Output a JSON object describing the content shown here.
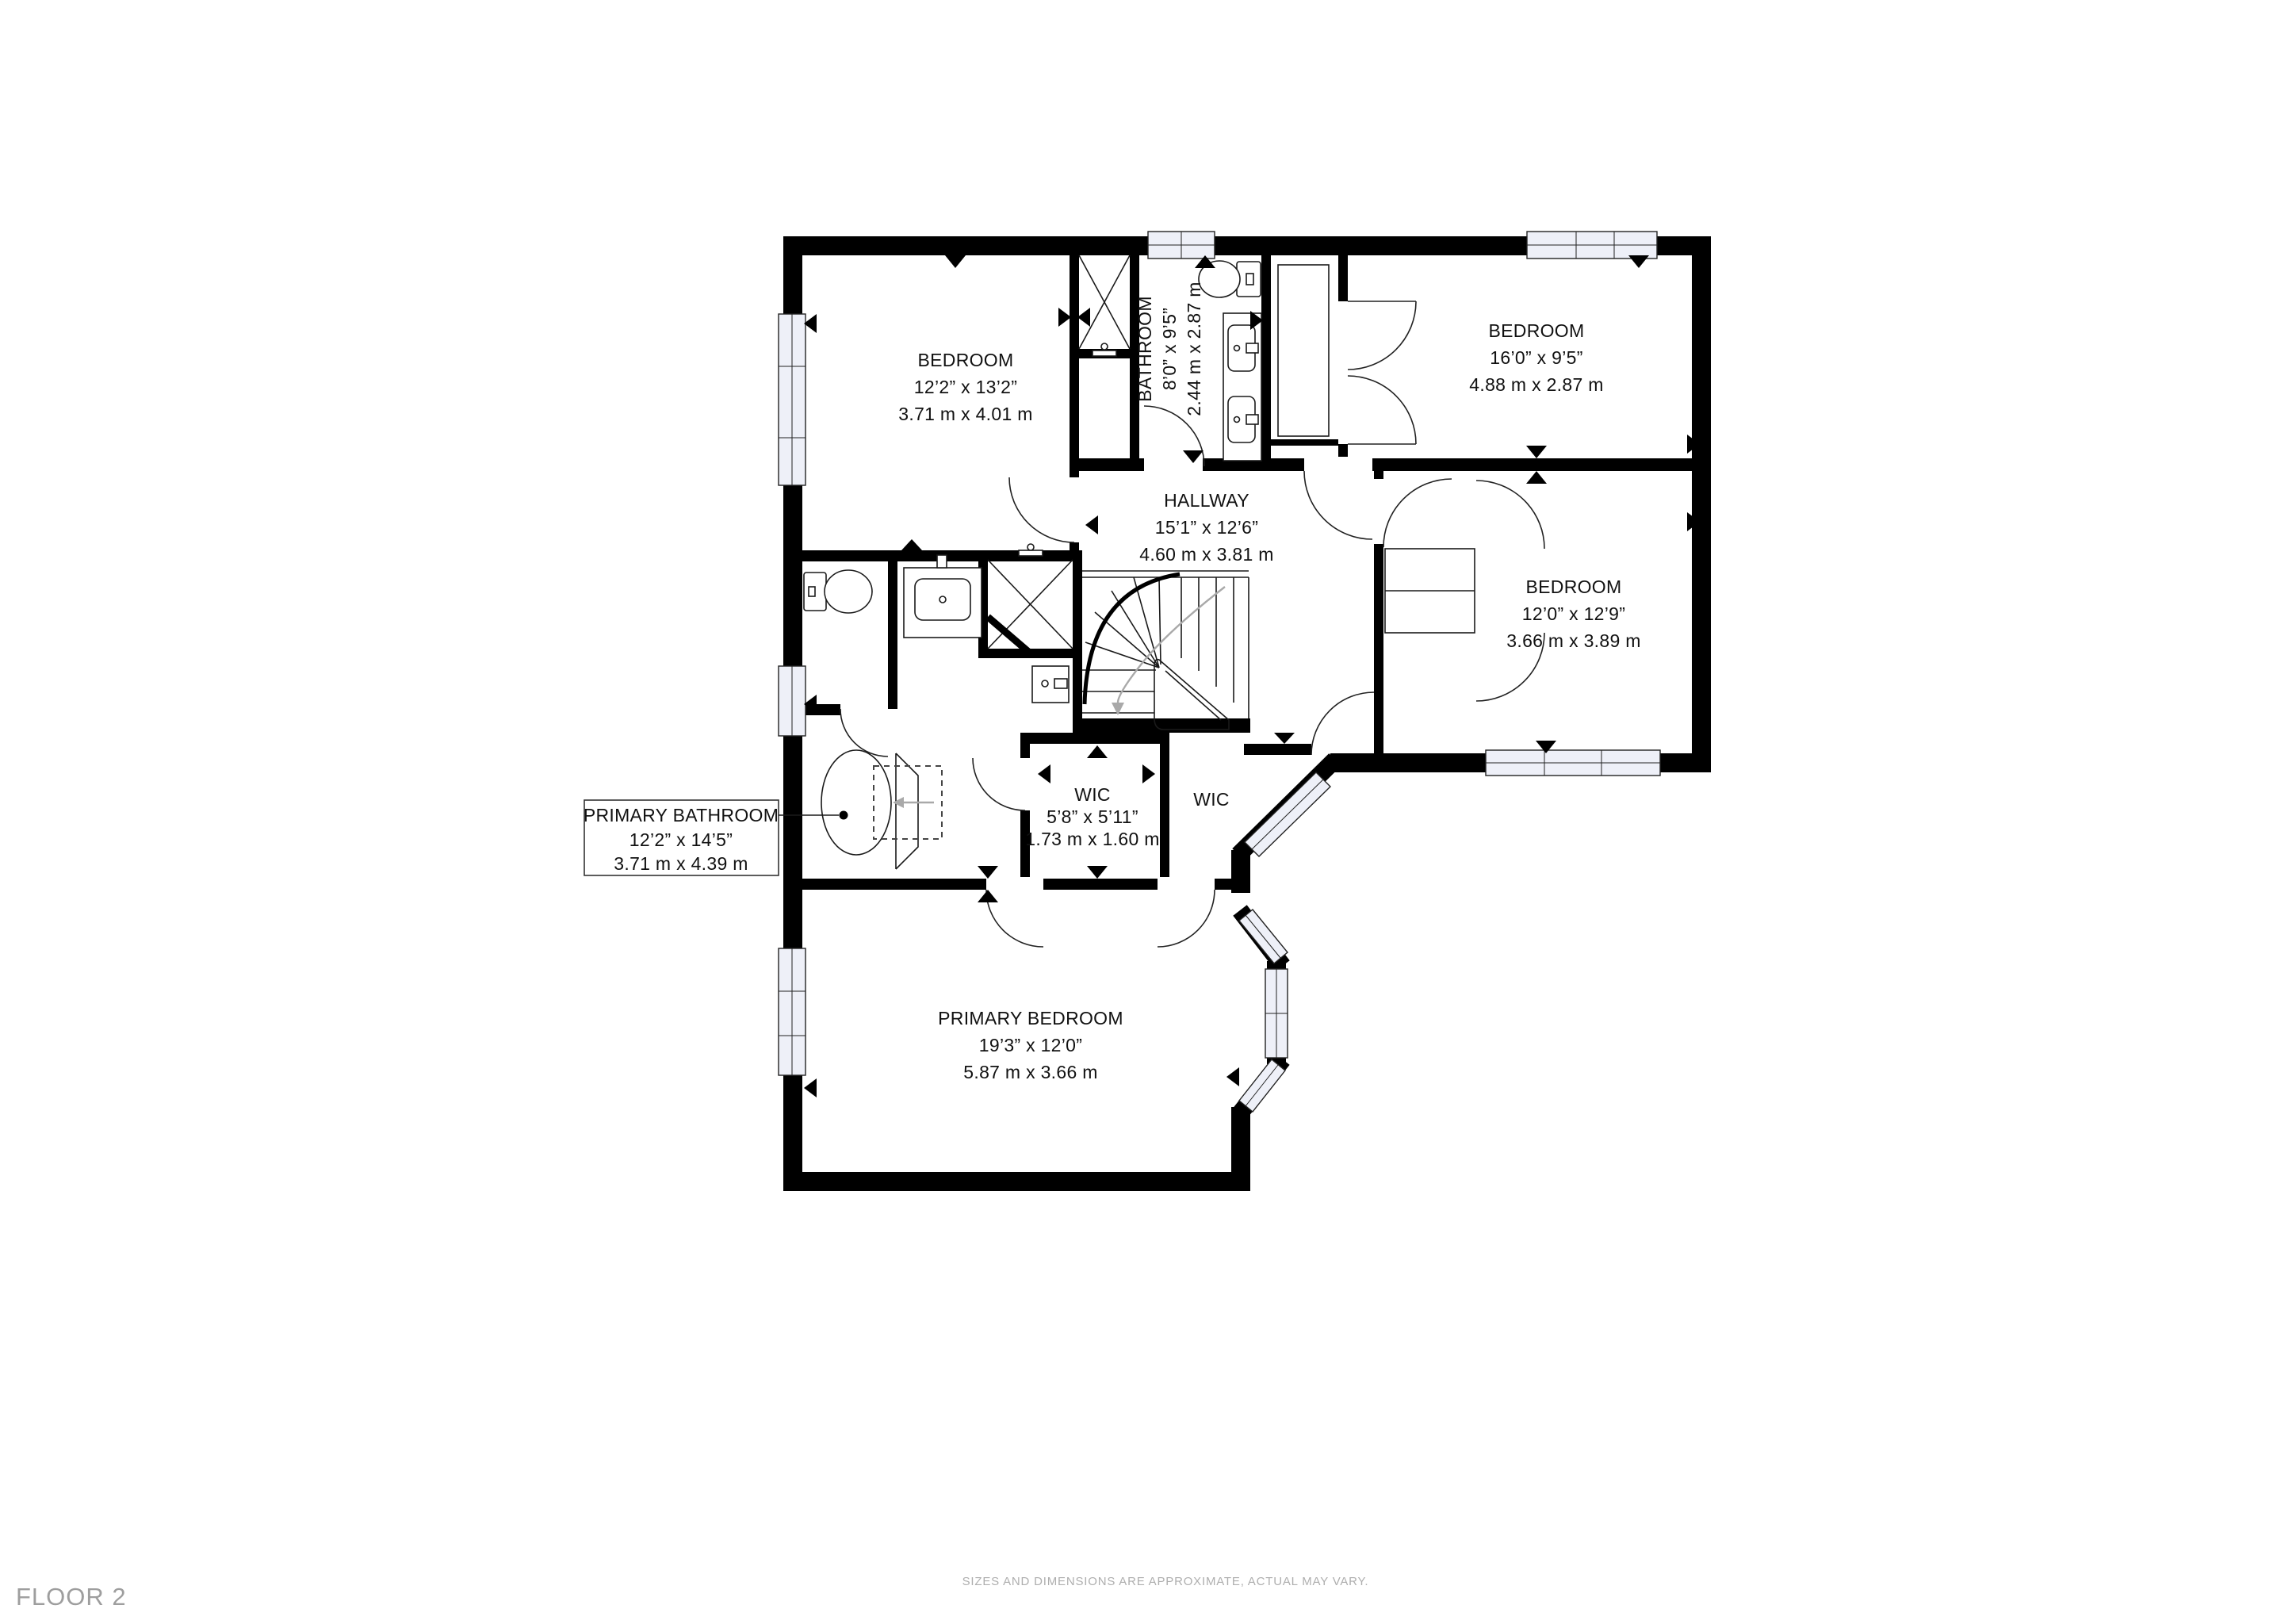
{
  "footer": {
    "floor_label": "FLOOR 2",
    "disclaimer": "SIZES AND DIMENSIONS ARE APPROXIMATE, ACTUAL MAY VARY."
  },
  "colors": {
    "walls": "#000000",
    "text": "#111111",
    "muted_gray": "#9e9e9e",
    "window_glass": "#eef0f8"
  },
  "rooms": {
    "bedroom1": {
      "name": "BEDROOM",
      "dim_ft": "12’2” x 13’2”",
      "dim_m": "3.71 m x 4.01 m"
    },
    "bathroom": {
      "name": "BATHROOM",
      "dim_ft": "8’0” x 9’5”",
      "dim_m": "2.44 m x 2.87 m"
    },
    "bedroom2": {
      "name": "BEDROOM",
      "dim_ft": "16’0” x 9’5”",
      "dim_m": "4.88 m x 2.87 m"
    },
    "hallway": {
      "name": "HALLWAY",
      "dim_ft": "15’1” x 12’6”",
      "dim_m": "4.60 m x 3.81 m"
    },
    "bedroom3": {
      "name": "BEDROOM",
      "dim_ft": "12’0” x 12’9”",
      "dim_m": "3.66 m x 3.89 m"
    },
    "wic": {
      "name": "WIC",
      "dim_ft": "5’8” x 5’11”",
      "dim_m": "1.73 m x 1.60 m"
    },
    "wic2": {
      "name": "WIC"
    },
    "primary_bathroom": {
      "name": "PRIMARY BATHROOM",
      "dim_ft": "12’2” x 14’5”",
      "dim_m": "3.71 m x 4.39 m"
    },
    "primary_bedroom": {
      "name": "PRIMARY BEDROOM",
      "dim_ft": "19’3” x 12’0”",
      "dim_m": "5.87 m x 3.66 m"
    }
  }
}
